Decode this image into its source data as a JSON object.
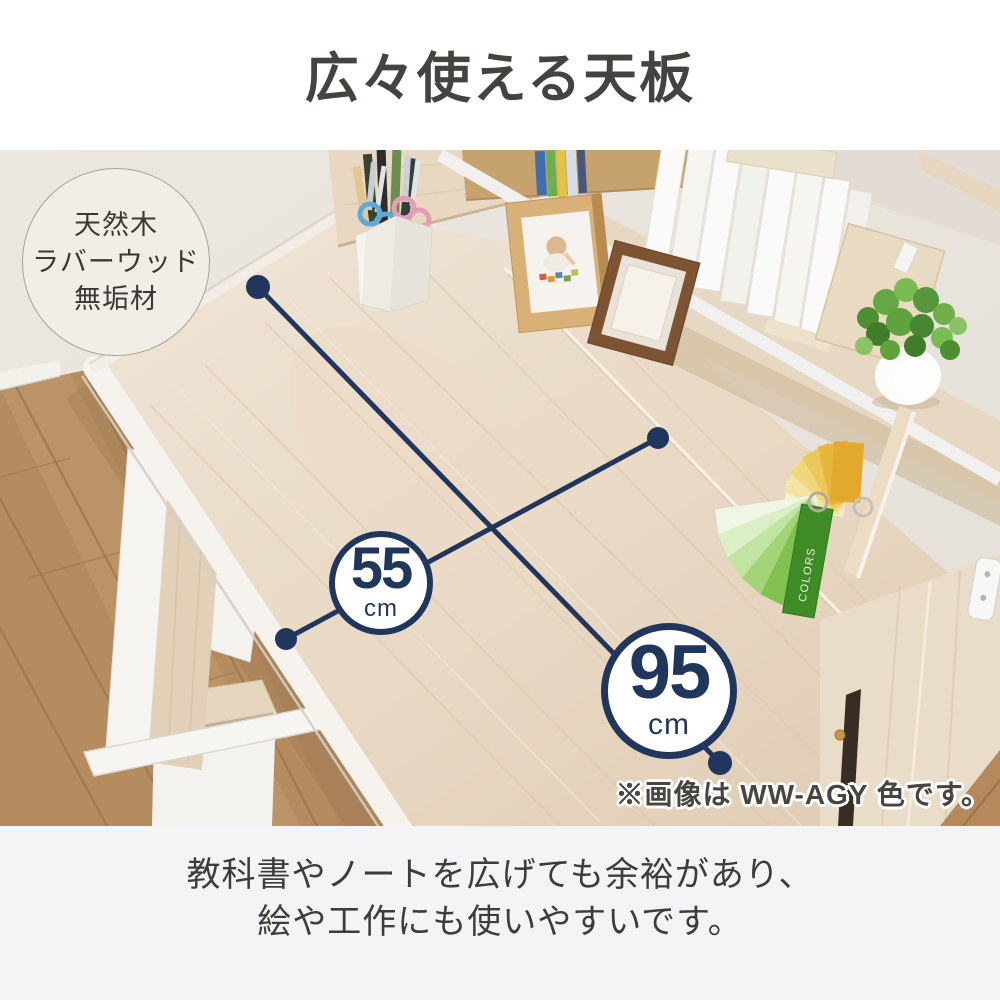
{
  "title": "広々使える天板",
  "material_badge": {
    "line1": "天然木",
    "line2": "ラバーウッド",
    "line3": "無垢材"
  },
  "measurements": {
    "depth": {
      "value": "55",
      "unit": "cm"
    },
    "width": {
      "value": "95",
      "unit": "cm"
    }
  },
  "photo": {
    "caption": "※画像は WW-AGY 色です。",
    "swatch_label": "COLORS"
  },
  "description": {
    "line1": "教科書やノートを広げても余裕があり、",
    "line2": "絵や工作にも使いやすいです。"
  },
  "colors": {
    "accent_navy": "#20365c",
    "title_text": "#454340",
    "body_text": "#3d3c3a",
    "footer_background": "#f4f4f6",
    "desk_wood": "#e8d8c4",
    "floor_wood": "#b48c5f",
    "wall": "#e9e5df",
    "background": "#ffffff"
  }
}
